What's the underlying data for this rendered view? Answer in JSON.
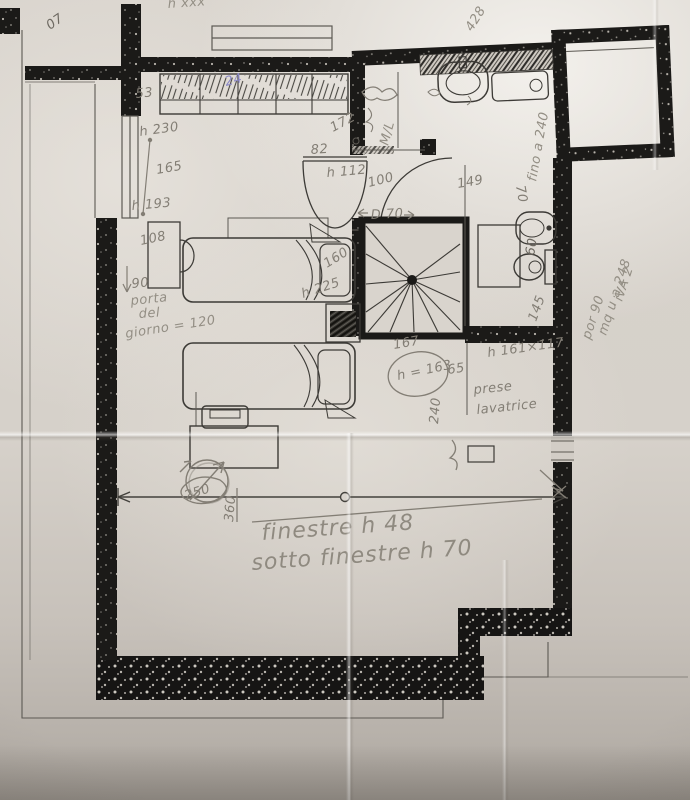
{
  "document": {
    "kind": "scanned hand-sketched apartment floor plan",
    "language": "Italian",
    "media": "pencil notes over photocopied plan"
  },
  "palette": {
    "paper": "#d9d4cd",
    "wall_ink": "#1b1a18",
    "wall_speckle": "#cac5bd",
    "plan_line": "#3c3a36",
    "pencil": "#837e75",
    "pen_blue": "#8b89c6"
  },
  "annotations": [
    {
      "text": "07"
    },
    {
      "text": "h xxx"
    },
    {
      "text": "428"
    },
    {
      "text": "24"
    },
    {
      "text": "53"
    },
    {
      "text": "h 230"
    },
    {
      "text": "165"
    },
    {
      "text": "h 193"
    },
    {
      "text": "172"
    },
    {
      "text": "82"
    },
    {
      "text": "h 112"
    },
    {
      "text": "100"
    },
    {
      "text": "D 70"
    },
    {
      "text": "108"
    },
    {
      "text": "90"
    },
    {
      "text": "porta"
    },
    {
      "text": "del"
    },
    {
      "text": "giorno = 120"
    },
    {
      "text": "160"
    },
    {
      "text": "h 225"
    },
    {
      "text": "149"
    },
    {
      "text": "70"
    },
    {
      "text": "fino a 240"
    },
    {
      "text": "145"
    },
    {
      "text": "167"
    },
    {
      "text": "h = 163"
    },
    {
      "text": "65"
    },
    {
      "text": "h 161×117"
    },
    {
      "text": "prese"
    },
    {
      "text": "lavatrice"
    },
    {
      "text": "240"
    },
    {
      "text": "iVA 2"
    },
    {
      "text": "mq u a 248"
    },
    {
      "text": "por 90"
    },
    {
      "text": "250"
    },
    {
      "text": "360"
    },
    {
      "text": "finestre h 48"
    },
    {
      "text": "sotto finestre h 70"
    },
    {
      "text": "M/L"
    },
    {
      "text": "60"
    }
  ]
}
